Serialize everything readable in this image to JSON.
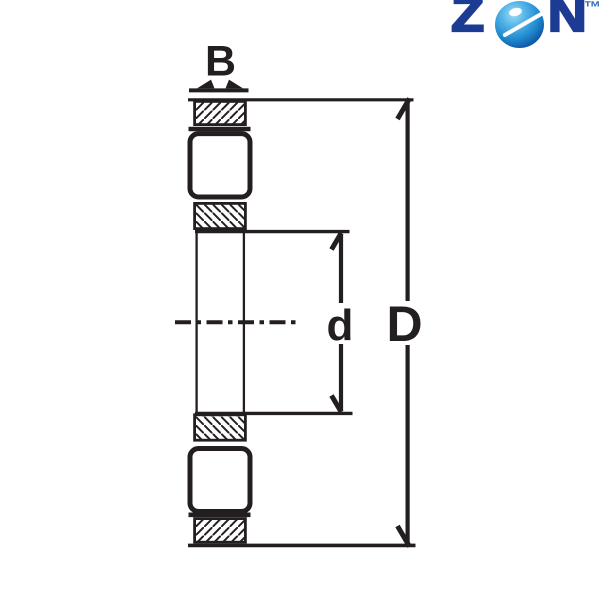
{
  "logo": {
    "letter_z": "Z",
    "letter_n": "N",
    "trademark": "™",
    "colors": {
      "navy": "#1c3c94",
      "tm_blue": "#2d6fc0",
      "sphere_highlight": "#9ddef7",
      "sphere_mid": "#1f8ad0",
      "sphere_dark": "#083077"
    }
  },
  "diagram": {
    "type": "bearing cross-section dimension drawing",
    "width_label": "B",
    "bore_label": "d",
    "outer_label": "D",
    "line_color": "#231f20",
    "background": "#ffffff"
  }
}
